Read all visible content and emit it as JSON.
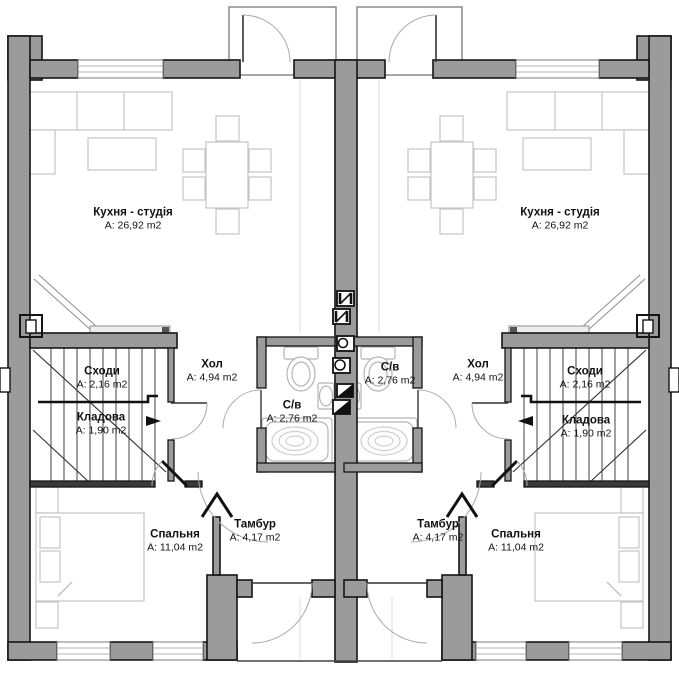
{
  "colors": {
    "wall_fill": "#9b9b9b",
    "outline": "#151515",
    "furniture_line": "#c4c4c4",
    "fixture_line": "#b5b5b5",
    "arc_line": "#a9a9a9"
  },
  "units": {
    "left": {
      "kitchen": {
        "name": "Кухня - студія",
        "area": "A: 26,92 m2"
      },
      "hall": {
        "name": "Хол",
        "area": "A: 4,94 m2"
      },
      "bathroom": {
        "name": "С/в",
        "area": "A: 2,76 m2"
      },
      "stairs": {
        "name": "Сходи",
        "area": "A: 2,16 m2"
      },
      "storage": {
        "name": "Кладова",
        "area": "A: 1,90 m2"
      },
      "bedroom": {
        "name": "Спальня",
        "area": "A: 11,04 m2"
      },
      "vestibule": {
        "name": "Тамбур",
        "area": "A: 4,17 m2"
      }
    },
    "right": {
      "kitchen": {
        "name": "Кухня - студія",
        "area": "A: 26,92 m2"
      },
      "hall": {
        "name": "Хол",
        "area": "A: 4,94 m2"
      },
      "bathroom": {
        "name": "С/в",
        "area": "A: 2,76 m2"
      },
      "stairs": {
        "name": "Сходи",
        "area": "A: 2,16 m2"
      },
      "storage": {
        "name": "Кладова",
        "area": "A: 1,90 m2"
      },
      "bedroom": {
        "name": "Спальня",
        "area": "A: 11,04 m2"
      },
      "vestibule": {
        "name": "Тамбур",
        "area": "A: 4,17 m2"
      }
    }
  }
}
